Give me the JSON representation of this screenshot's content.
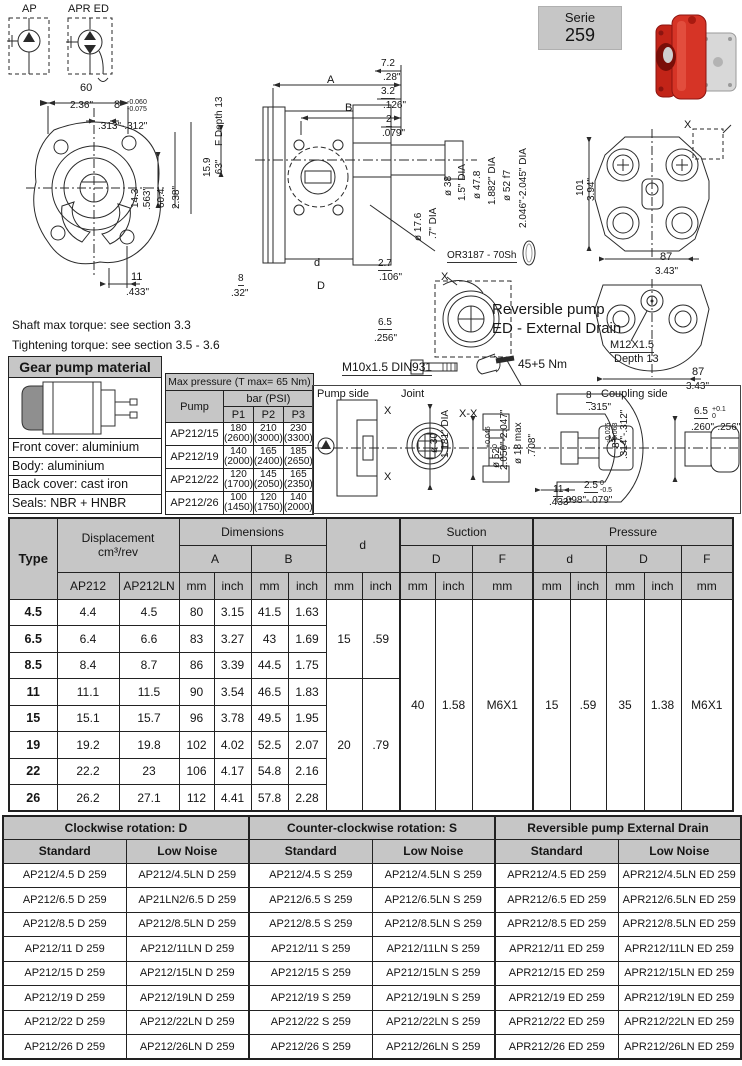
{
  "serie": {
    "line1": "Serie",
    "line2": "259"
  },
  "colors": {
    "header_gray": "#c6c6c6",
    "pump_red": "#d63426",
    "line": "#2a2a2a"
  },
  "notes": {
    "n1": "Shaft max torque: see section 3.3",
    "n2": "Tightening torque: see section 3.5 - 3.6"
  },
  "material": {
    "title": "Gear pump material",
    "rows": [
      "Front cover: aluminium",
      "Body: aluminium",
      "Back cover: cast iron",
      "Seals: NBR + HNBR"
    ]
  },
  "max_pressure": {
    "title": "Max pressure (T max= 65 Nm)",
    "pump": "Pump",
    "unit": "bar (PSI)",
    "cols": [
      "P1",
      "P2",
      "P3"
    ],
    "rows": [
      {
        "name": "AP212/15",
        "v": [
          [
            "180",
            "(2600)"
          ],
          [
            "210",
            "(3000)"
          ],
          [
            "230",
            "(3300)"
          ]
        ]
      },
      {
        "name": "AP212/19",
        "v": [
          [
            "140",
            "(2000)"
          ],
          [
            "165",
            "(2400)"
          ],
          [
            "185",
            "(2650)"
          ]
        ]
      },
      {
        "name": "AP212/22",
        "v": [
          [
            "120",
            "(1700)"
          ],
          [
            "145",
            "(2050)"
          ],
          [
            "165",
            "(2350)"
          ]
        ]
      },
      {
        "name": "AP212/26",
        "v": [
          [
            "100",
            "(1450)"
          ],
          [
            "120",
            "(1750)"
          ],
          [
            "140",
            "(2000)"
          ]
        ]
      }
    ]
  },
  "main_table": {
    "header": {
      "type": "Type",
      "disp1": "Displacement",
      "disp2": "cm³/rev",
      "ap212": "AP212",
      "ap212ln": "AP212LN",
      "dimensions": "Dimensions",
      "a": "A",
      "b": "B",
      "d": "d",
      "D": "D",
      "f": "F",
      "suction": "Suction",
      "pressure": "Pressure",
      "mm": "mm",
      "inch": "inch"
    },
    "rows": [
      [
        "4.5",
        "4.4",
        "4.5",
        "80",
        "3.15",
        "41.5",
        "1.63"
      ],
      [
        "6.5",
        "6.4",
        "6.6",
        "83",
        "3.27",
        "43",
        "1.69"
      ],
      [
        "8.5",
        "8.4",
        "8.7",
        "86",
        "3.39",
        "44.5",
        "1.75"
      ],
      [
        "11",
        "11.1",
        "11.5",
        "90",
        "3.54",
        "46.5",
        "1.83"
      ],
      [
        "15",
        "15.1",
        "15.7",
        "96",
        "3.78",
        "49.5",
        "1.95"
      ],
      [
        "19",
        "19.2",
        "19.8",
        "102",
        "4.02",
        "52.5",
        "2.07"
      ],
      [
        "22",
        "22.2",
        "23",
        "106",
        "4.17",
        "54.8",
        "2.16"
      ],
      [
        "26",
        "26.2",
        "27.1",
        "112",
        "4.41",
        "57.8",
        "2.28"
      ]
    ],
    "d_groups": [
      {
        "mm": "15",
        "inch": ".59"
      },
      {
        "mm": "20",
        "inch": ".79"
      }
    ],
    "suction": {
      "d_mm": "40",
      "d_inch": "1.58",
      "f": "M6X1"
    },
    "pressure": {
      "d_mm": "15",
      "d_inch": ".59",
      "D_mm": "35",
      "D_inch": "1.38",
      "f": "M6X1"
    }
  },
  "order_table": {
    "groups": [
      "Clockwise rotation: D",
      "Counter-clockwise rotation: S",
      "Reversible pump External Drain"
    ],
    "sub": [
      "Standard",
      "Low Noise"
    ],
    "rows": [
      [
        "AP212/4.5 D 259",
        "AP212/4.5LN D 259",
        "AP212/4.5 S 259",
        "AP212/4.5LN S 259",
        "APR212/4.5 ED 259",
        "APR212/4.5LN ED 259"
      ],
      [
        "AP212/6.5 D 259",
        "AP21LN2/6.5 D 259",
        "AP212/6.5 S 259",
        "AP212/6.5LN S 259",
        "APR212/6.5 ED 259",
        "APR212/6.5LN ED 259"
      ],
      [
        "AP212/8.5 D 259",
        "AP212/8.5LN D 259",
        "AP212/8.5 S 259",
        "AP212/8.5LN S 259",
        "APR212/8.5 ED 259",
        "APR212/8.5LN ED 259"
      ],
      [
        "AP212/11 D 259",
        "AP212/11LN D 259",
        "AP212/11 S 259",
        "AP212/11LN S 259",
        "APR212/11 ED 259",
        "APR212/11LN ED 259"
      ],
      [
        "AP212/15 D 259",
        "AP212/15LN D 259",
        "AP212/15 S 259",
        "AP212/15LN S 259",
        "APR212/15 ED 259",
        "APR212/15LN ED 259"
      ],
      [
        "AP212/19 D 259",
        "AP212/19LN D 259",
        "AP212/19 S 259",
        "AP212/19LN S 259",
        "APR212/19 ED 259",
        "APR212/19LN ED 259"
      ],
      [
        "AP212/22 D 259",
        "AP212/22LN D 259",
        "AP212/22 S 259",
        "AP212/22LN S 259",
        "APR212/22 ED 259",
        "APR212/22LN ED 259"
      ],
      [
        "AP212/26 D 259",
        "AP212/26LN D 259",
        "AP212/26 S 259",
        "AP212/26LN S 259",
        "APR212/26 ED 259",
        "APR212/26LN ED 259"
      ]
    ]
  },
  "drawing": {
    "symbols": {
      "ap": "AP",
      "apr": "APR ED"
    },
    "flange": {
      "mm60": "60",
      "in236": "2.36\"",
      "n8": "8",
      "tol_t": "-0.060",
      "tol_b": "-0.075",
      "in313": ".313\"-.312\"",
      "mm143": "14.3",
      "in563": ".563\"",
      "mm604": "60.4",
      "in238": "2.38\"",
      "mm11": "11",
      "in433": ".433\""
    },
    "section": {
      "A": "A",
      "B": "B",
      "mm72": "7.2",
      "in28": ".28\"",
      "mm32": "3.2",
      "in126": ".126\"",
      "mm2": "2",
      "in079": ".079\"",
      "mm159": "15.9",
      "in63": ".63\"",
      "fdepth": "F Depth 13",
      "mm8": "8",
      "in32": ".32\"",
      "d": "d",
      "D": "D",
      "mm27": "2.7",
      "in106": ".106\"",
      "mm65": "6.5",
      "in256": ".256\"",
      "d38": "ø 38",
      "d15": "1.5\" DIA",
      "d478": "ø 47.8",
      "d1882": "1.882\" DIA",
      "d52": "ø 52 f7",
      "d2046": "2.046\"-2.045\" DIA",
      "d176": "ø 17.6",
      "d7": ".7\" DIA",
      "oring": "OR3187 - 70Sh",
      "bolt": "M10x1.5 DIN931",
      "torque": "45+5 Nm",
      "x": "X",
      "rev1": "Reversible pump",
      "rev2": "ED - External Drain"
    },
    "back": {
      "x": "X",
      "mm101": "101",
      "in394": "3.94\"",
      "mm87": "87",
      "in343": "3.43\"",
      "m12": "M12X1.5",
      "depth": "Depth 13",
      "mm87b": "87",
      "in343b": "3.43\""
    },
    "panel": {
      "pump_side": "Pump side",
      "joint": "Joint",
      "coupling_side": "Coupling side",
      "x1": "X",
      "x2": "X",
      "xx": "X-X",
      "d30": "ø 30",
      "d1181": "1.181\" DIA",
      "mm11": "11",
      "in433": ".433\"",
      "mm8": "8",
      "in315": ".315\"",
      "d52": "ø 52",
      "d52t": "+0.046",
      "d52b": "0",
      "in2050": "2.050\"-2.047\"",
      "d18": "ø 18 max",
      "in708": ".708\"",
      "mm25": "2.5",
      "t25t": "0",
      "t25b": "-0.5",
      "in098": ".098\"-.079\"",
      "mm8b": "8",
      "t8t": "-0.025",
      "t8b": "-0.063",
      "in314": ".314\"-.312\"",
      "mm65": "6.5",
      "t65t": "+0.1",
      "t65b": "0",
      "in260": ".260\"-.256\"",
      "m": "M"
    }
  }
}
